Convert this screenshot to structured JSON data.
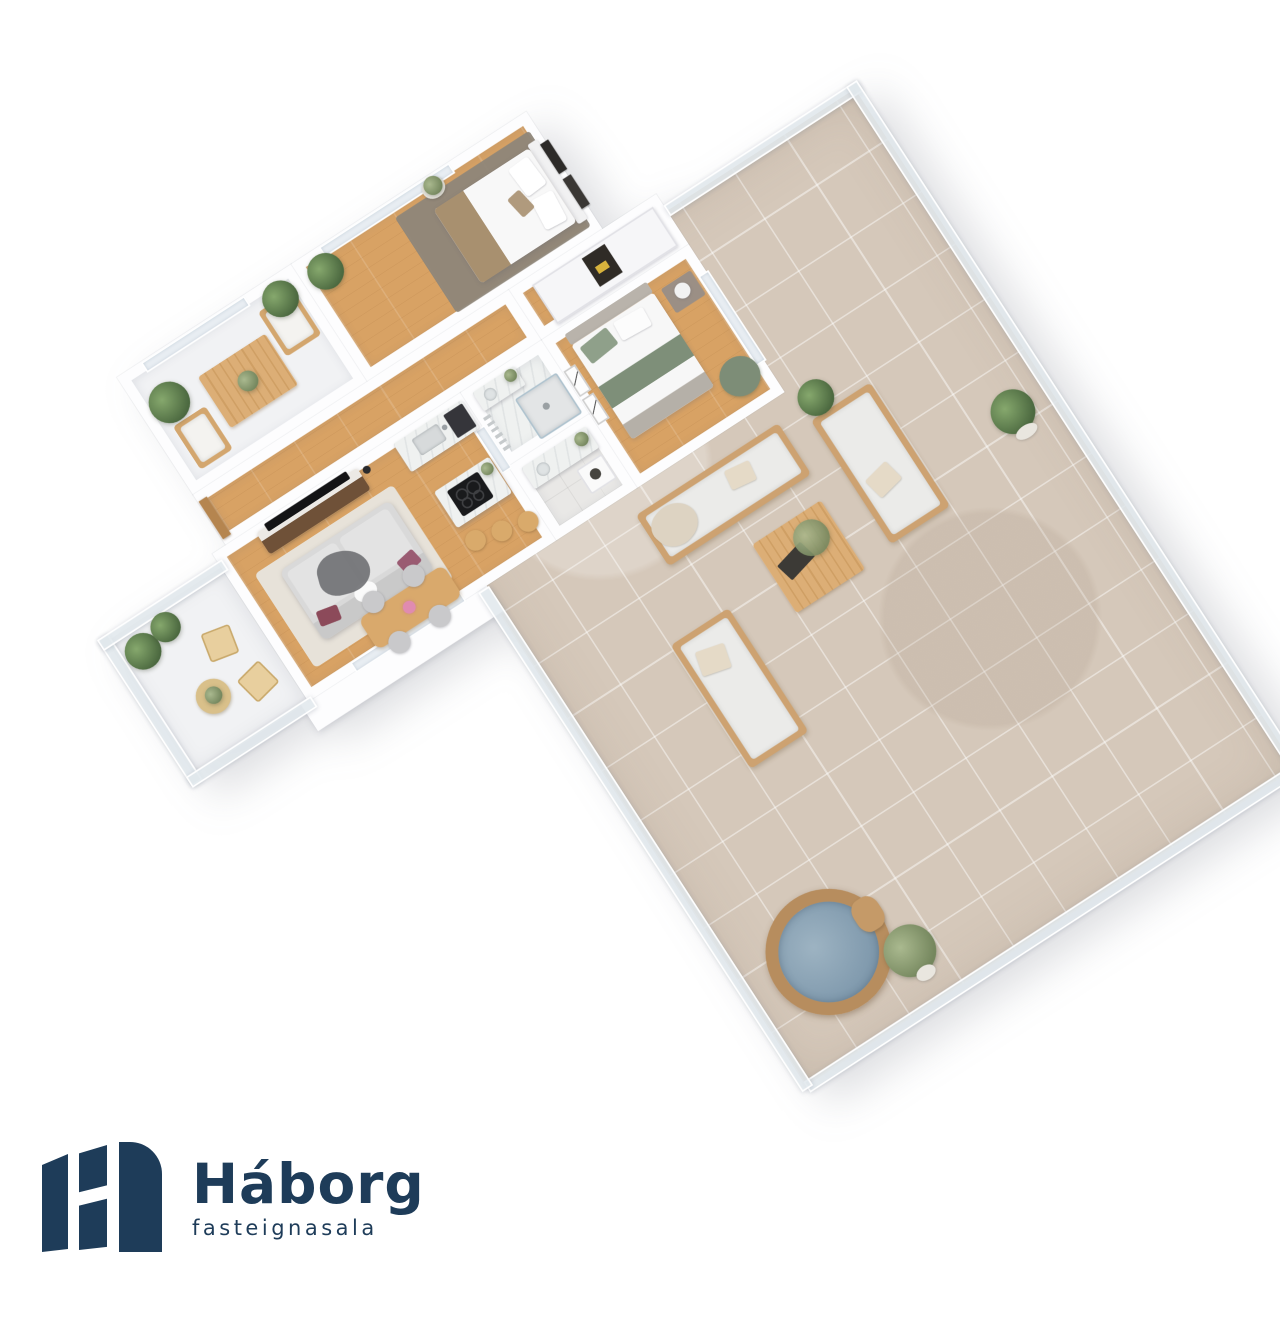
{
  "brand": {
    "name": "Háborg",
    "tagline": "fasteignasala"
  },
  "icons": {
    "logo_mark": "three-navy-building-bars-forming-H"
  },
  "colors": {
    "navy": "#1e3c59",
    "wall": "#fdfdfe",
    "wood": "#d8a264",
    "tile": "#d5c8ba",
    "cushion": "#ebebe9",
    "outdoorWood": "#cda271",
    "water": "#87a0b2",
    "sofaGray": "#d9d9d9",
    "maroon": "#8c4a5a",
    "sage": "#8fa08a",
    "masterRug": "#8e8679",
    "blanket": "#a8906f"
  }
}
